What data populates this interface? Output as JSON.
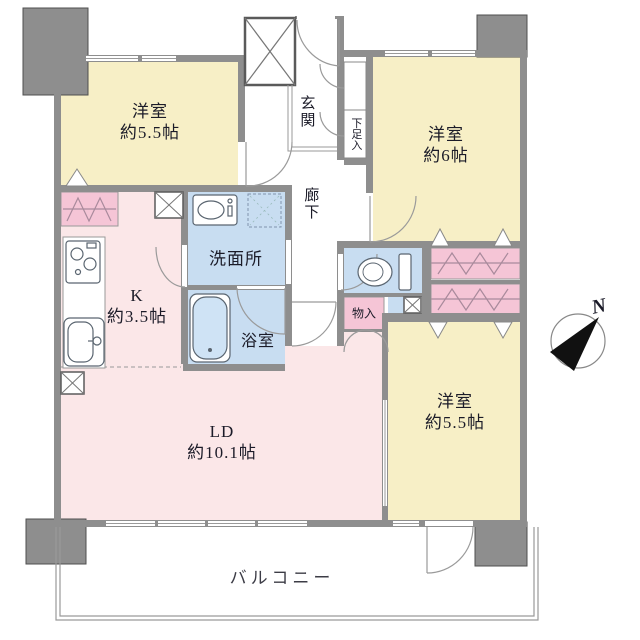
{
  "floorplan": {
    "title": "apartment-floor-plan",
    "rooms": {
      "bedroom_top_left": {
        "label": "洋室",
        "size": "約5.5帖"
      },
      "bedroom_top_right": {
        "label": "洋室",
        "size": "約6帖"
      },
      "bedroom_bottom_right": {
        "label": "洋室",
        "size": "約5.5帖"
      },
      "living_dining": {
        "label": "LD",
        "size": "約10.1帖"
      },
      "kitchen": {
        "label": "K",
        "size": "約3.5帖"
      },
      "washroom": {
        "label": "洗面所"
      },
      "bathroom": {
        "label": "浴室"
      },
      "corridor": {
        "label": "廊下"
      },
      "entrance": {
        "label": "玄関"
      },
      "shoe_cabinet": {
        "label": "下足入"
      },
      "storage": {
        "label": "物入"
      },
      "balcony": {
        "label": "バルコニー"
      }
    },
    "compass": {
      "north_label": "N"
    },
    "colors": {
      "bedroom_yellow": "#f7efc6",
      "living_pink": "#fbe7e8",
      "closet_pink": "#f5c5d6",
      "wet_area_blue": "#c8ddf1",
      "tub_blue": "#cfe3f5",
      "wall_gray": "#8e8e8e",
      "line_gray": "#9a9a9a"
    }
  }
}
